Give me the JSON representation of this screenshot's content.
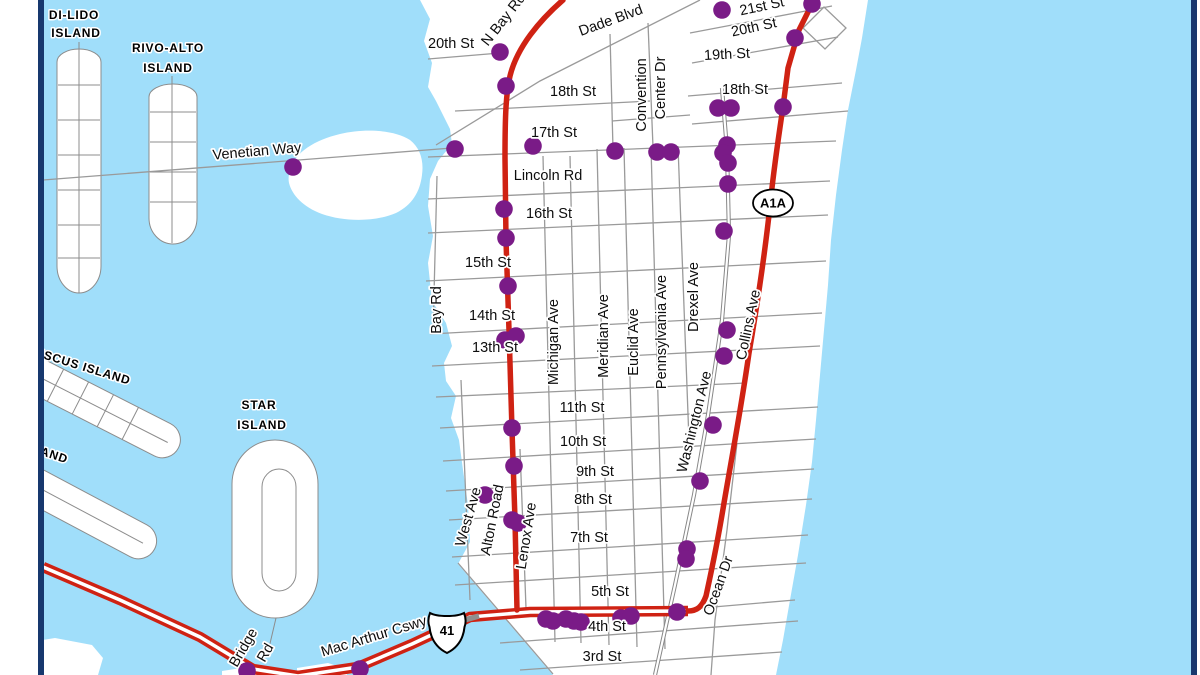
{
  "colors": {
    "water": "#a0defa",
    "land": "#ffffff",
    "street_gray": "#9a9a9a",
    "island_stroke": "#8c8c8c",
    "route_red": "#cf2213",
    "stop_purple": "#7a1b87",
    "border_navy": "#17386e",
    "label_black": "#0d0d0d",
    "halo_white": "#ffffff",
    "bridge_gray": "#8f8f8f"
  },
  "shapes": {
    "mainland": "M 420,0 L 868,0 L 862,38 L 856,70 L 848,110 L 842,150 L 836,195 L 831,240 L 828,285 L 824,330 L 820,375 L 816,420 L 812,462 L 806,505 L 798,555 L 790,600 L 783,640 L 776,675 L 553,675 L 458,564 L 470,542 L 468,505 L 463,470 L 459,440 L 451,418 L 456,396 L 446,381 L 444,363 L 452,346 L 446,323 L 432,301 L 428,263 L 433,236 L 428,206 L 430,179 L 438,161 L 452,144 L 450,129 L 436,101 L 428,87 L 432,63 L 424,41 L 430,19 Z",
    "belle_isle": "M 290,170 C 295,152 315,140 340,134 C 365,128 395,130 410,140 C 420,148 424,160 422,175 C 420,192 412,205 396,213 C 375,222 345,222 322,214 C 303,207 292,195 289,183 C 288,178 289,174 290,170 Z",
    "islands": [
      {
        "d": "M 57,62 L 57,266 A 22,27 0 0 0 101,266 L 101,62 A 22,13 0 0 0 57,62 Z",
        "f": 1
      },
      {
        "d": "M 79,42 L 79,293 M 58,85 L 100,85 M 58,120 L 100,120 M 58,155 L 100,155 M 58,190 L 100,190 M 58,225 L 100,225 M 58,258 L 100,258",
        "f": 0
      },
      {
        "d": "M 149,97 L 149,218 A 24,26 0 0 0 197,218 L 197,97 A 24,13 0 0 0 149,97 Z",
        "f": 1
      },
      {
        "d": "M 172,76 L 172,243 M 150,112 L 196,112 M 150,142 L 196,142 M 150,172 L 196,172 M 150,202 L 196,202",
        "f": 0
      },
      {
        "d": "M 26,390 L 170,390 A 18,18 0 0 1 170,426 L 26,426 A 18,18 0 0 1 26,390 Z",
        "t": "rotate(27 100 408)",
        "f": 1
      },
      {
        "d": "M 32,408 L 176,408 M 50,390 L 50,426 M 78,390 L 78,426 M 106,390 L 106,426 M 134,390 L 134,426",
        "t": "rotate(27 100 408)",
        "f": 0
      },
      {
        "d": "M 30,497 L 145,497 A 18,18 0 0 1 145,533 L 30,533 A 18,18 0 0 1 30,497 Z",
        "t": "rotate(28 90 515)",
        "f": 1
      },
      {
        "d": "M 34,515 L 150,515",
        "t": "rotate(28 90 515)",
        "f": 0
      },
      {
        "d": "M 232,484 L 232,574 A 43,44 0 0 0 318,574 L 318,484 A 43,44 0 0 0 232,484 Z",
        "f": 1
      },
      {
        "d": "M 262,487 L 262,573 A 17,18 0 0 0 296,573 L 296,487 A 17,18 0 0 0 262,487 Z M 276,618 L 268,652",
        "f": 0
      },
      {
        "d": "M 12,645 L 55,638 L 92,645 L 103,658 L 98,675 L 12,675 Z",
        "f": 2
      },
      {
        "d": "M 297,668 L 328,663 L 346,669 L 347,675 L 297,675 Z",
        "f": 2
      },
      {
        "d": "M 222,671 L 248,667 L 256,675 L 222,675 Z",
        "f": 2
      }
    ]
  },
  "streets": [
    "M 690,33 L 832,6",
    "M 692,63 L 838,37",
    "M 688,96 L 842,83",
    "M 692,124 L 848,111",
    "M 455,111 L 650,101",
    "M 428,157 L 836,141",
    "M 428,199 L 830,181",
    "M 428,233 L 828,215",
    "M 426,281 L 826,261",
    "M 430,334 L 822,313",
    "M 432,366 L 820,346",
    "M 436,397 L 746,383",
    "M 440,428 L 818,407",
    "M 443,461 L 816,439",
    "M 446,491 L 814,469",
    "M 449,520 L 812,499",
    "M 452,557 L 808,535",
    "M 455,585 L 806,563",
    "M 690,609 L 795,600",
    "M 500,643 L 798,621",
    "M 520,670 L 782,652",
    "M 458,563 L 553,674",
    "M 437,176 L 433,334",
    "M 461,380 L 470,600",
    "M 520,449 L 526,608",
    "M 543,156 L 555,642",
    "M 570,156 L 581,643",
    "M 597,149 L 609,645",
    "M 624,148 L 637,647",
    "M 651,147 L 665,649",
    "M 678,146 L 689,441",
    "M 610,34 L 613,149",
    "M 648,23 L 653,147",
    "M 612,121 L 690,115",
    "M 700,0 L 540,81 L 436,145",
    "M 428,59 L 500,53",
    "M 43,180 L 452,148",
    "M 737,443 L 727,530 L 715,620 L 711,675",
    "M 803,28 L 824,7 L 846,28 L 825,49 Z"
  ],
  "double_roads": [
    {
      "d": "M 722,88 L 727,150 L 729,235 L 722,320 L 708,415 L 694,495 L 675,585 L 655,675"
    }
  ],
  "routes": {
    "alton": {
      "d": "M 563,0 C 540,20 517,47 510,76 C 506,93 505,115 505,158 L 506,240 L 509,330 L 512,430 L 515,520 L 517,610",
      "w": 5.5
    },
    "collins": {
      "d": "M 814,0 L 799,30 L 788,68 L 783,107 C 777,147 773,176 770,206 C 765,252 757,306 749,353 C 741,409 732,456 724,503 C 717,546 711,573 706,596 C 702,607 697,611 688,611",
      "w": 5.5
    },
    "us41": {
      "d": "M 43,567 L 120,600 L 200,637 L 253,669 L 298,676 L 358,667 L 412,644 L 470,617 L 530,612 L 688,611",
      "outer": 10.5,
      "core": 3.6
    }
  },
  "bridge_mark": "M 461,621 L 479,616",
  "shields": [
    {
      "type": "oval",
      "label": "A1A",
      "x": 773,
      "y": 203
    },
    {
      "type": "us",
      "label": "41",
      "x": 447,
      "y": 628
    }
  ],
  "stops": [
    [
      293,
      167
    ],
    [
      500,
      52
    ],
    [
      506,
      86
    ],
    [
      455,
      149
    ],
    [
      533,
      146
    ],
    [
      615,
      151
    ],
    [
      657,
      152
    ],
    [
      671,
      152
    ],
    [
      722,
      10
    ],
    [
      812,
      4
    ],
    [
      795,
      38
    ],
    [
      718,
      108
    ],
    [
      731,
      108
    ],
    [
      783,
      107
    ],
    [
      727,
      145
    ],
    [
      723,
      153
    ],
    [
      728,
      163
    ],
    [
      728,
      184
    ],
    [
      724,
      231
    ],
    [
      504,
      209
    ],
    [
      506,
      238
    ],
    [
      508,
      286
    ],
    [
      505,
      340
    ],
    [
      516,
      336
    ],
    [
      727,
      330
    ],
    [
      724,
      356
    ],
    [
      512,
      428
    ],
    [
      713,
      425
    ],
    [
      514,
      466
    ],
    [
      700,
      481
    ],
    [
      485,
      495
    ],
    [
      512,
      520
    ],
    [
      518,
      523
    ],
    [
      687,
      549
    ],
    [
      686,
      559
    ],
    [
      546,
      619
    ],
    [
      553,
      621
    ],
    [
      566,
      619
    ],
    [
      574,
      621
    ],
    [
      581,
      622
    ],
    [
      621,
      618
    ],
    [
      631,
      616
    ],
    [
      677,
      612
    ],
    [
      247,
      671
    ],
    [
      360,
      669
    ]
  ],
  "stop_radius": 8.8,
  "labels": [
    {
      "t": "DI-LIDO",
      "x": 74,
      "y": 16,
      "r": 0,
      "s": "island"
    },
    {
      "t": "ISLAND",
      "x": 76,
      "y": 34,
      "r": 0,
      "s": "island"
    },
    {
      "t": "RIVO-ALTO",
      "x": 168,
      "y": 49,
      "r": 0,
      "s": "island"
    },
    {
      "t": "ISLAND",
      "x": 168,
      "y": 69,
      "r": 0,
      "s": "island"
    },
    {
      "t": "ISCUS ISLAND",
      "x": 85,
      "y": 368,
      "r": 17,
      "s": "island"
    },
    {
      "t": "AND",
      "x": 54,
      "y": 456,
      "r": 18,
      "s": "island"
    },
    {
      "t": "STAR",
      "x": 259,
      "y": 406,
      "r": 0,
      "s": "island"
    },
    {
      "t": "ISLAND",
      "x": 262,
      "y": 426,
      "r": 0,
      "s": "island"
    },
    {
      "t": "Venetian Way",
      "x": 257,
      "y": 152,
      "r": -5,
      "s": "street"
    },
    {
      "t": "20th St",
      "x": 451,
      "y": 44,
      "r": 0,
      "s": "street"
    },
    {
      "t": "N Bay Rd",
      "x": 504,
      "y": 20,
      "r": -52,
      "s": "street"
    },
    {
      "t": "Dade Blvd",
      "x": 611,
      "y": 21,
      "r": -20,
      "s": "street"
    },
    {
      "t": "21st St",
      "x": 762,
      "y": 7,
      "r": -12,
      "s": "street"
    },
    {
      "t": "20th St",
      "x": 754,
      "y": 28,
      "r": -12,
      "s": "street"
    },
    {
      "t": "19th St",
      "x": 727,
      "y": 55,
      "r": -3,
      "s": "street"
    },
    {
      "t": "18th St",
      "x": 745,
      "y": 90,
      "r": 0,
      "s": "street"
    },
    {
      "t": "18th St",
      "x": 573,
      "y": 92,
      "r": 0,
      "s": "street"
    },
    {
      "t": "17th St",
      "x": 554,
      "y": 133,
      "r": 0,
      "s": "street"
    },
    {
      "t": "Lincoln Rd",
      "x": 548,
      "y": 176,
      "r": 0,
      "s": "street"
    },
    {
      "t": "16th St",
      "x": 549,
      "y": 214,
      "r": 0,
      "s": "street"
    },
    {
      "t": "15th St",
      "x": 488,
      "y": 263,
      "r": 0,
      "s": "street"
    },
    {
      "t": "14th St",
      "x": 492,
      "y": 316,
      "r": 0,
      "s": "street"
    },
    {
      "t": "13th St",
      "x": 495,
      "y": 348,
      "r": 0,
      "s": "street"
    },
    {
      "t": "11th St",
      "x": 582,
      "y": 408,
      "r": 0,
      "s": "street"
    },
    {
      "t": "10th St",
      "x": 583,
      "y": 442,
      "r": 0,
      "s": "street"
    },
    {
      "t": "9th St",
      "x": 595,
      "y": 472,
      "r": 0,
      "s": "street"
    },
    {
      "t": "8th St",
      "x": 593,
      "y": 500,
      "r": 0,
      "s": "street"
    },
    {
      "t": "7th St",
      "x": 589,
      "y": 538,
      "r": 0,
      "s": "street"
    },
    {
      "t": "5th St",
      "x": 610,
      "y": 592,
      "r": 0,
      "s": "street"
    },
    {
      "t": "4th St",
      "x": 607,
      "y": 627,
      "r": 0,
      "s": "street"
    },
    {
      "t": "3rd St",
      "x": 602,
      "y": 657,
      "r": 0,
      "s": "street"
    },
    {
      "t": "Bay Rd",
      "x": 437,
      "y": 310,
      "r": -90,
      "s": "street"
    },
    {
      "t": "Michigan Ave",
      "x": 554,
      "y": 342,
      "r": -90,
      "s": "street"
    },
    {
      "t": "Meridian Ave",
      "x": 604,
      "y": 336,
      "r": -90,
      "s": "street"
    },
    {
      "t": "Euclid Ave",
      "x": 634,
      "y": 342,
      "r": -90,
      "s": "street"
    },
    {
      "t": "Pennsylvania Ave",
      "x": 662,
      "y": 332,
      "r": -90,
      "s": "street"
    },
    {
      "t": "Drexel Ave",
      "x": 694,
      "y": 297,
      "r": -90,
      "s": "street"
    },
    {
      "t": "Collins Ave",
      "x": 749,
      "y": 325,
      "r": -78,
      "s": "street"
    },
    {
      "t": "Washington Ave",
      "x": 695,
      "y": 422,
      "r": -76,
      "s": "street"
    },
    {
      "t": "Convention",
      "x": 642,
      "y": 95,
      "r": -90,
      "s": "street"
    },
    {
      "t": "Center Dr",
      "x": 661,
      "y": 88,
      "r": -90,
      "s": "street"
    },
    {
      "t": "West Ave",
      "x": 469,
      "y": 517,
      "r": -74,
      "s": "street"
    },
    {
      "t": "Alton Road",
      "x": 493,
      "y": 520,
      "r": -79,
      "s": "street"
    },
    {
      "t": "Lenox Ave",
      "x": 527,
      "y": 536,
      "r": -81,
      "s": "street"
    },
    {
      "t": "Ocean Dr",
      "x": 719,
      "y": 586,
      "r": -70,
      "s": "street"
    },
    {
      "t": "Mac Arthur Cswy",
      "x": 374,
      "y": 637,
      "r": -17,
      "s": "street"
    },
    {
      "t": "Bridge",
      "x": 244,
      "y": 648,
      "r": -60,
      "s": "street"
    },
    {
      "t": "Rd",
      "x": 266,
      "y": 653,
      "r": -60,
      "s": "street"
    }
  ],
  "frame": {
    "left_white": [
      0,
      0,
      38,
      675
    ],
    "left_navy": [
      38,
      0,
      6,
      675
    ],
    "right_navy": [
      1191,
      0,
      6,
      675
    ],
    "right_white": [
      1197,
      0,
      3,
      675
    ]
  }
}
